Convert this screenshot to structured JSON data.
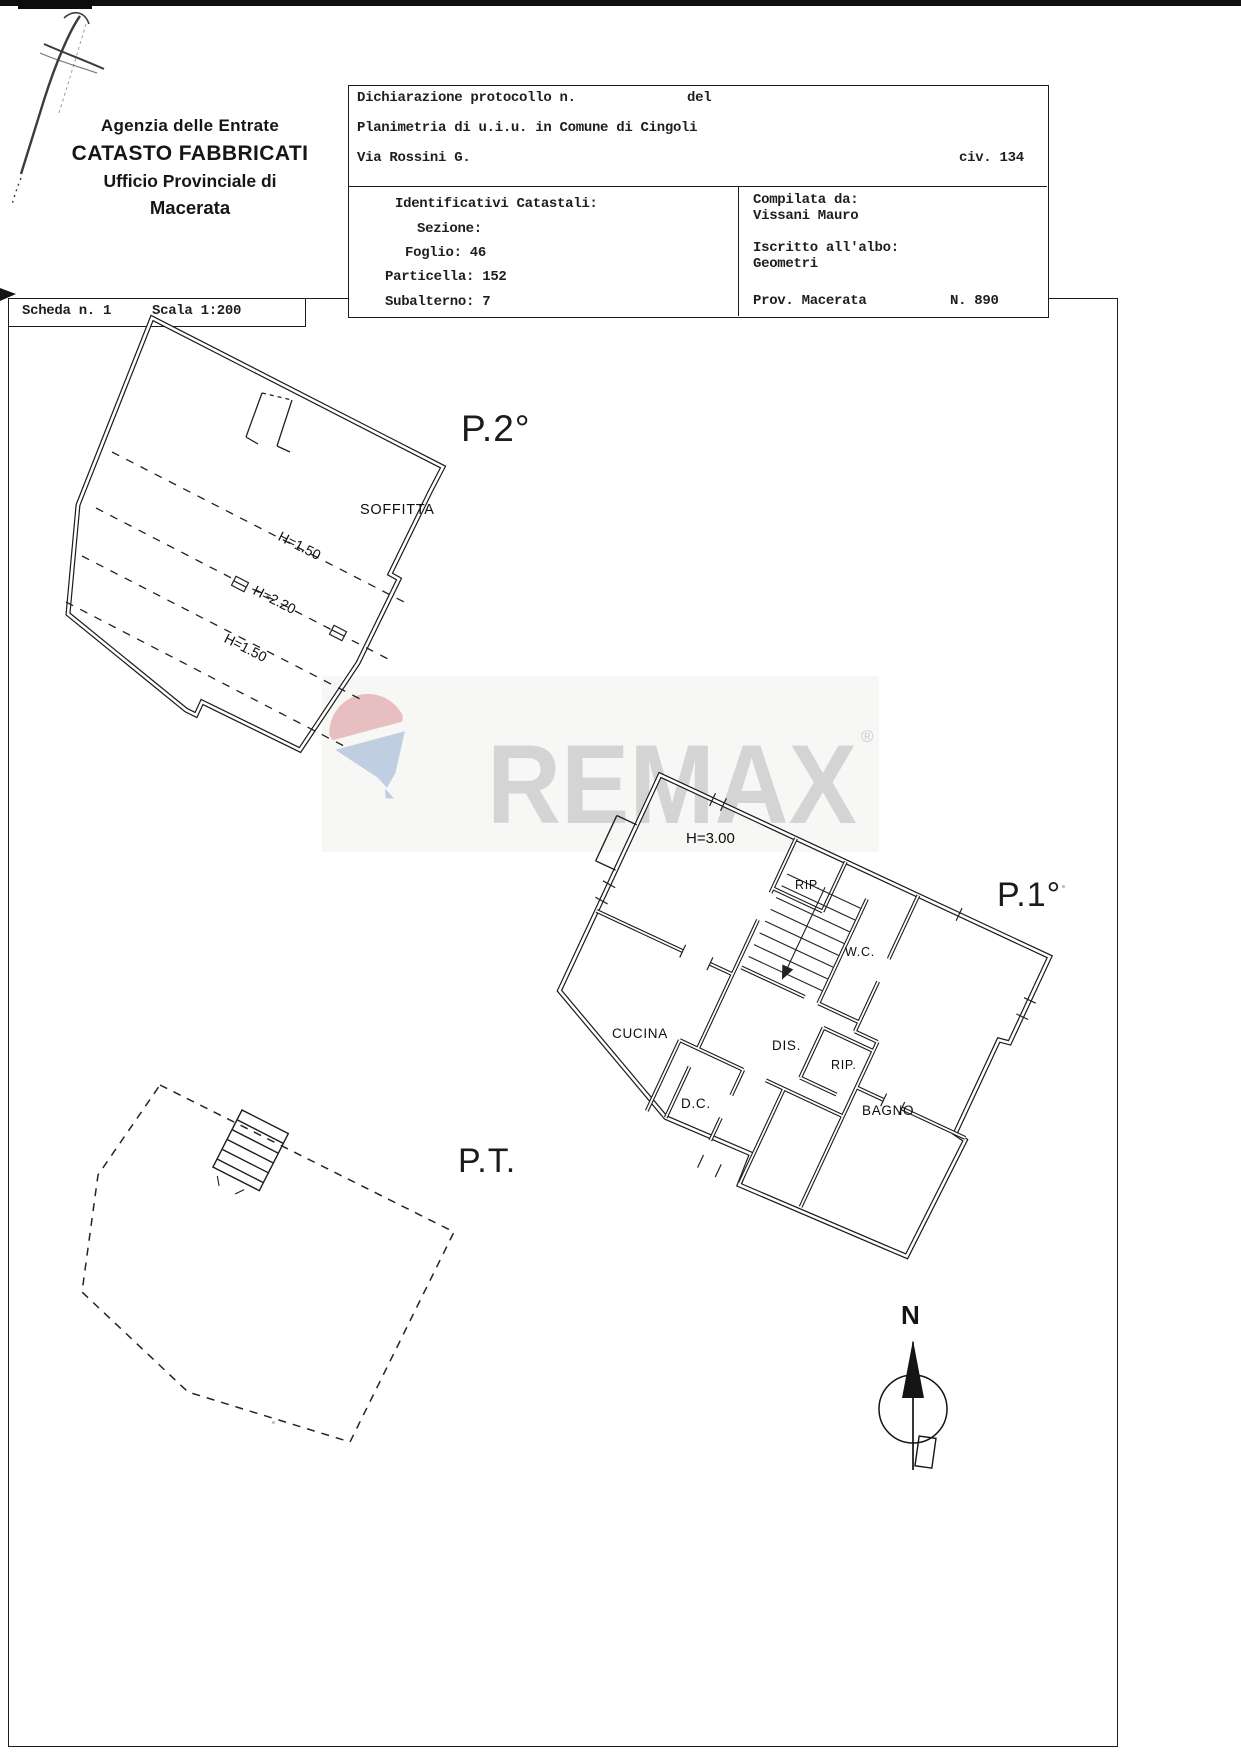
{
  "header": {
    "agency_line1": "Agenzia delle Entrate",
    "agency_line2": "CATASTO FABBRICATI",
    "agency_line3": "Ufficio Provinciale di",
    "agency_line4": "Macerata"
  },
  "scheda": {
    "label": "Scheda n. 1",
    "scale": "Scala 1:200"
  },
  "protocol": {
    "line1_label": "Dichiarazione protocollo n.",
    "line1_del": "del",
    "line2": "Planimetria di u.i.u. in Comune di Cingoli",
    "street": "Via Rossini G.",
    "civic": "civ. 134"
  },
  "catastali": {
    "title": "Identificativi Catastali:",
    "sezione": "Sezione:",
    "foglio": "Foglio: 46",
    "particella": "Particella: 152",
    "subalterno": "Subalterno: 7"
  },
  "compiler": {
    "compilata_label": "Compilata da:",
    "name": "Vissani Mauro",
    "albo_label": "Iscritto all'albo:",
    "albo_value": "Geometri",
    "prov": "Prov. Macerata",
    "num": "N. 890"
  },
  "plans": {
    "p2": {
      "title": "P.2°",
      "room": "SOFFITTA",
      "heights": [
        "H=1.50",
        "H=2.20",
        "H=1.50"
      ]
    },
    "p1": {
      "title": "P.1°",
      "height": "H=3.00",
      "rooms": [
        "RIP.",
        "W.C.",
        "CUCINA",
        "DIS.",
        "RIP.",
        "D.C.",
        "BAGNO"
      ]
    },
    "pt": {
      "title": "P.T."
    }
  },
  "watermark": {
    "text": "REMAX",
    "reg": "®"
  },
  "north": {
    "label": "N"
  },
  "colors": {
    "remax_red": "#dc9296",
    "remax_blue": "#92aed0",
    "watermark_gray": "#d4d4d4",
    "ink": "#1c1c1c"
  }
}
